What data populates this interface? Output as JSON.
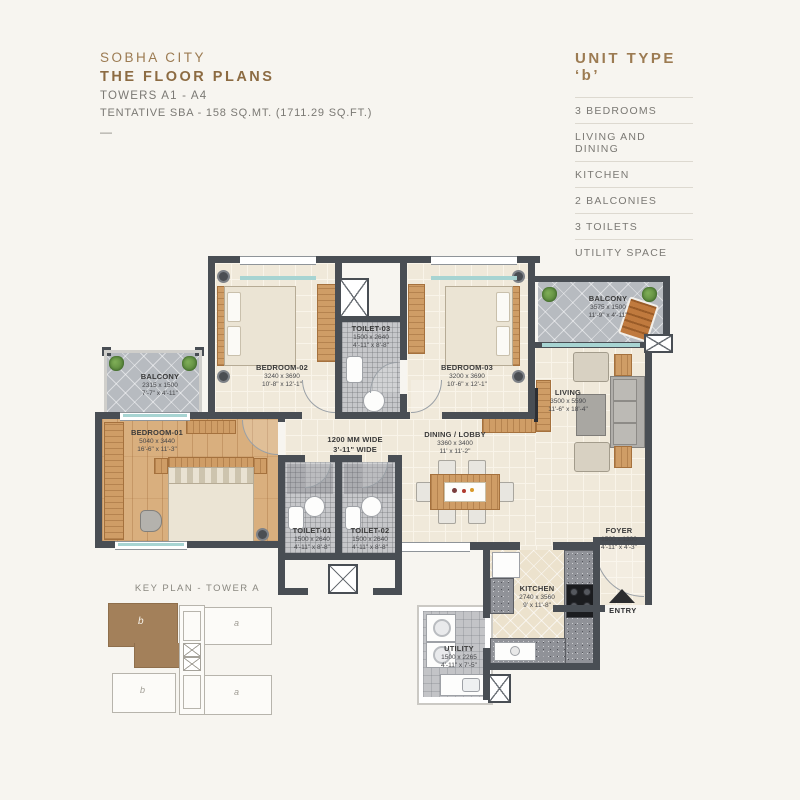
{
  "header": {
    "project": "SOBHA CITY",
    "title": "THE FLOOR PLANS",
    "towers": "TOWERS A1 - A4",
    "sba": "TENTATIVE SBA - 158 SQ.MT. (1711.29 SQ.FT.)",
    "dash": "—"
  },
  "unit_panel": {
    "title": "UNIT TYPE ‘b’",
    "features": [
      "3 BEDROOMS",
      "LIVING AND DINING",
      "KITCHEN",
      "2 BALCONIES",
      "3 TOILETS",
      "UTILITY SPACE"
    ]
  },
  "rooms": {
    "bedroom01": {
      "name": "BEDROOM-01",
      "mm": "5040 x 3440",
      "ft": "16'-6\" x 11'-3\""
    },
    "bedroom02": {
      "name": "BEDROOM-02",
      "mm": "3240 x 3690",
      "ft": "10'-8\" x 12'-1\""
    },
    "bedroom03": {
      "name": "BEDROOM-03",
      "mm": "3200 x 3690",
      "ft": "10'-6\" x 12'-1\""
    },
    "toilet01": {
      "name": "TOILET-01",
      "mm": "1500 x 2640",
      "ft": "4'-11\" x 8'-8\""
    },
    "toilet02": {
      "name": "TOILET-02",
      "mm": "1500 x 2640",
      "ft": "4'-11\" x 8'-8\""
    },
    "toilet03": {
      "name": "TOILET-03",
      "mm": "1500 x 2640",
      "ft": "4'-11\" x 8'-8\""
    },
    "balcony_left": {
      "name": "BALCONY",
      "mm": "2315 x 1500",
      "ft": "7'-7\" x 4'-11\""
    },
    "balcony_right": {
      "name": "BALCONY",
      "mm": "3575 x 1500",
      "ft": "11'-9\" x 4'-11\""
    },
    "living": {
      "name": "LIVING",
      "mm": "3500 x 5590",
      "ft": "11'-6\" x 18'-4\""
    },
    "dining": {
      "name": "DINING / LOBBY",
      "mm": "3360 x 3400",
      "ft": "11' x 11'-2\""
    },
    "kitchen": {
      "name": "KITCHEN",
      "mm": "2740 x 3560",
      "ft": "9' x 11'-8\""
    },
    "utility": {
      "name": "UTILITY",
      "mm": "1500 x 2265",
      "ft": "4'-11\" x 7'-5\""
    },
    "foyer": {
      "name": "FOYER",
      "mm": "1500 x 1300",
      "ft": "4'-11\" x 4'-3\""
    },
    "passage": {
      "line1": "1200 MM WIDE",
      "line2": "3'-11\" WIDE"
    },
    "entry": "ENTRY"
  },
  "key_plan": {
    "title": "KEY PLAN - TOWER A",
    "units": [
      "b",
      "a",
      "b",
      "a"
    ]
  },
  "colors": {
    "accent": "#9c7b52",
    "accent_dark": "#8c6b42",
    "wall": "#494e54",
    "text_gray": "#7b7974",
    "plan_text": "#3a3a3a",
    "key_highlight": "#a3805a",
    "glass": "#a7d4d2"
  }
}
